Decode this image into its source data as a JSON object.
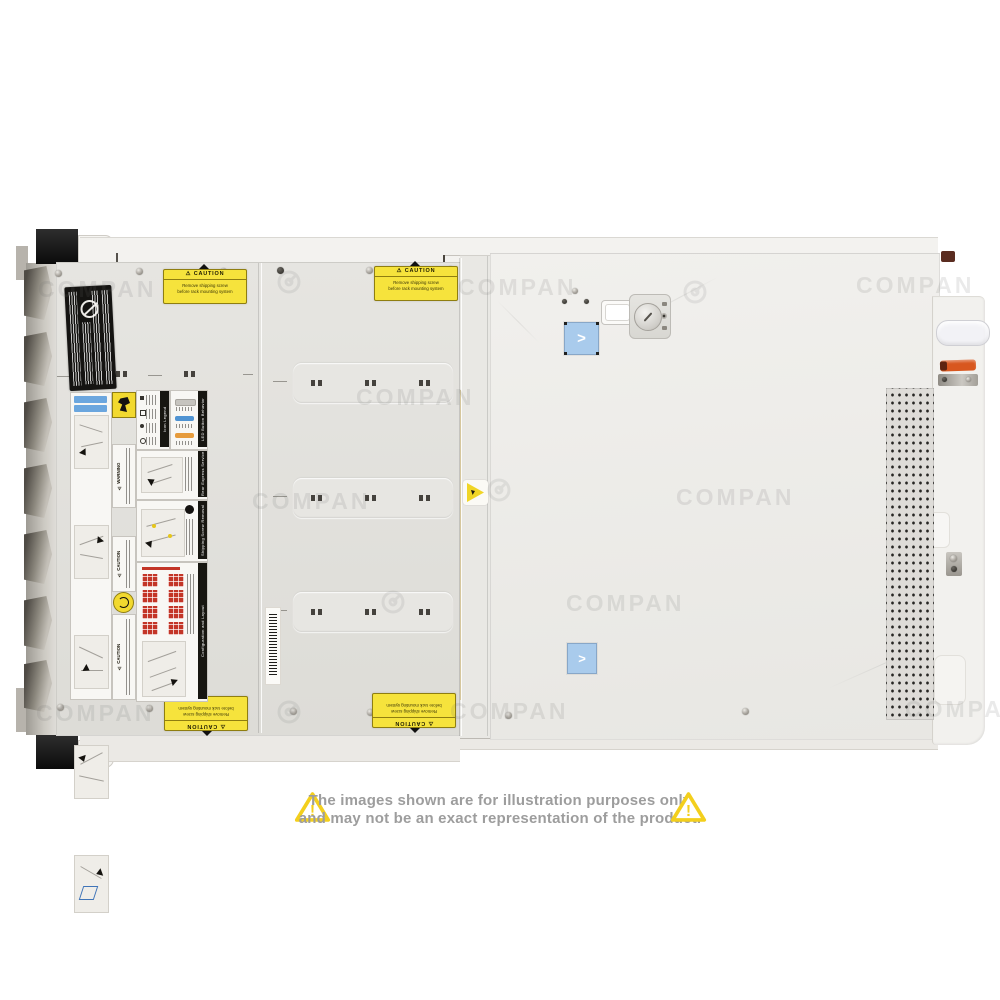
{
  "watermark": {
    "text": "COMPAN",
    "logo": "company-swirl"
  },
  "disclaimer": {
    "line1": "The images shown are for illustration purposes only",
    "line2": "and may not be an exact representation of the product.",
    "icon": "!"
  },
  "server": {
    "caution_label": {
      "heading": "⚠ CAUTION",
      "line1": "Remove shipping screw",
      "line2": "before rack mounting system"
    },
    "strip_labels": {
      "warning": "⚠ WARNING",
      "caution": "⚠ CAUTION"
    },
    "info_labels": {
      "icon_legend": "Icon Legend",
      "led_button_behavior": "LED Button Behavior",
      "rear_express_service_tag": "Rear Express Service Tag",
      "shipping_screw_removal": "Shipping Screw Removal",
      "configuration_and_layout": "Configuration and Layout"
    },
    "icons": {
      "chevron_right": ">"
    },
    "colors": {
      "cover_left": "#e3e2de",
      "cover_right": "#efeeeb",
      "label_yellow": "#f6e33c",
      "accent_blue": "#a9cbec",
      "accent_orange": "#d8571f",
      "led_blue": "#4f93d2",
      "led_orange": "#e69b3c",
      "config_red": "#c33527"
    }
  }
}
